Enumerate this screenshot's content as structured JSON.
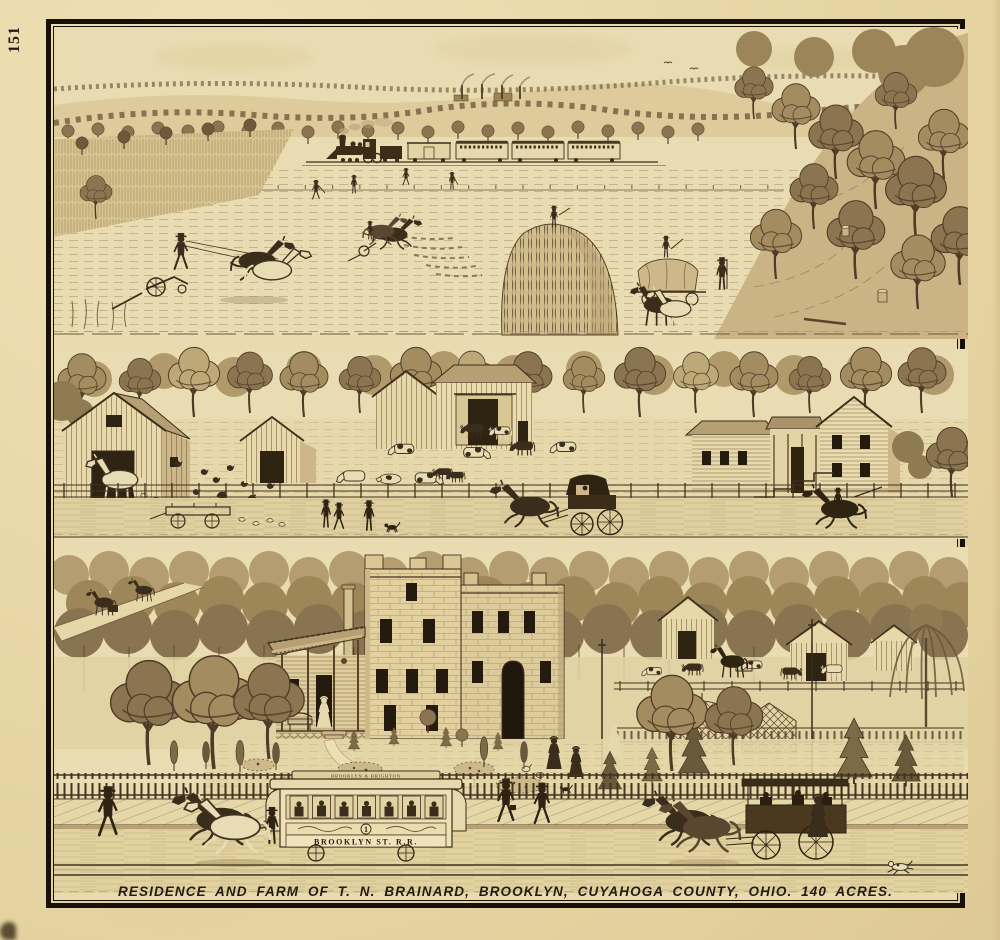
{
  "page": {
    "number": "151",
    "caption": "RESIDENCE AND FARM OF T. N. BRAINARD, BROOKLYN, CUYAHOGA COUNTY, OHIO. 140 ACRES."
  },
  "streetcar": {
    "roof_sign": "BROOKLYN & BRIGHTON",
    "car_number": "1",
    "name_panel": "BROOKLYN ST. R.R."
  },
  "colors": {
    "paper": "#e8d7a8",
    "paper_light": "#efe1b6",
    "ink": "#43331f",
    "ink_light": "#6d5a3b",
    "frame": "#17110a"
  }
}
